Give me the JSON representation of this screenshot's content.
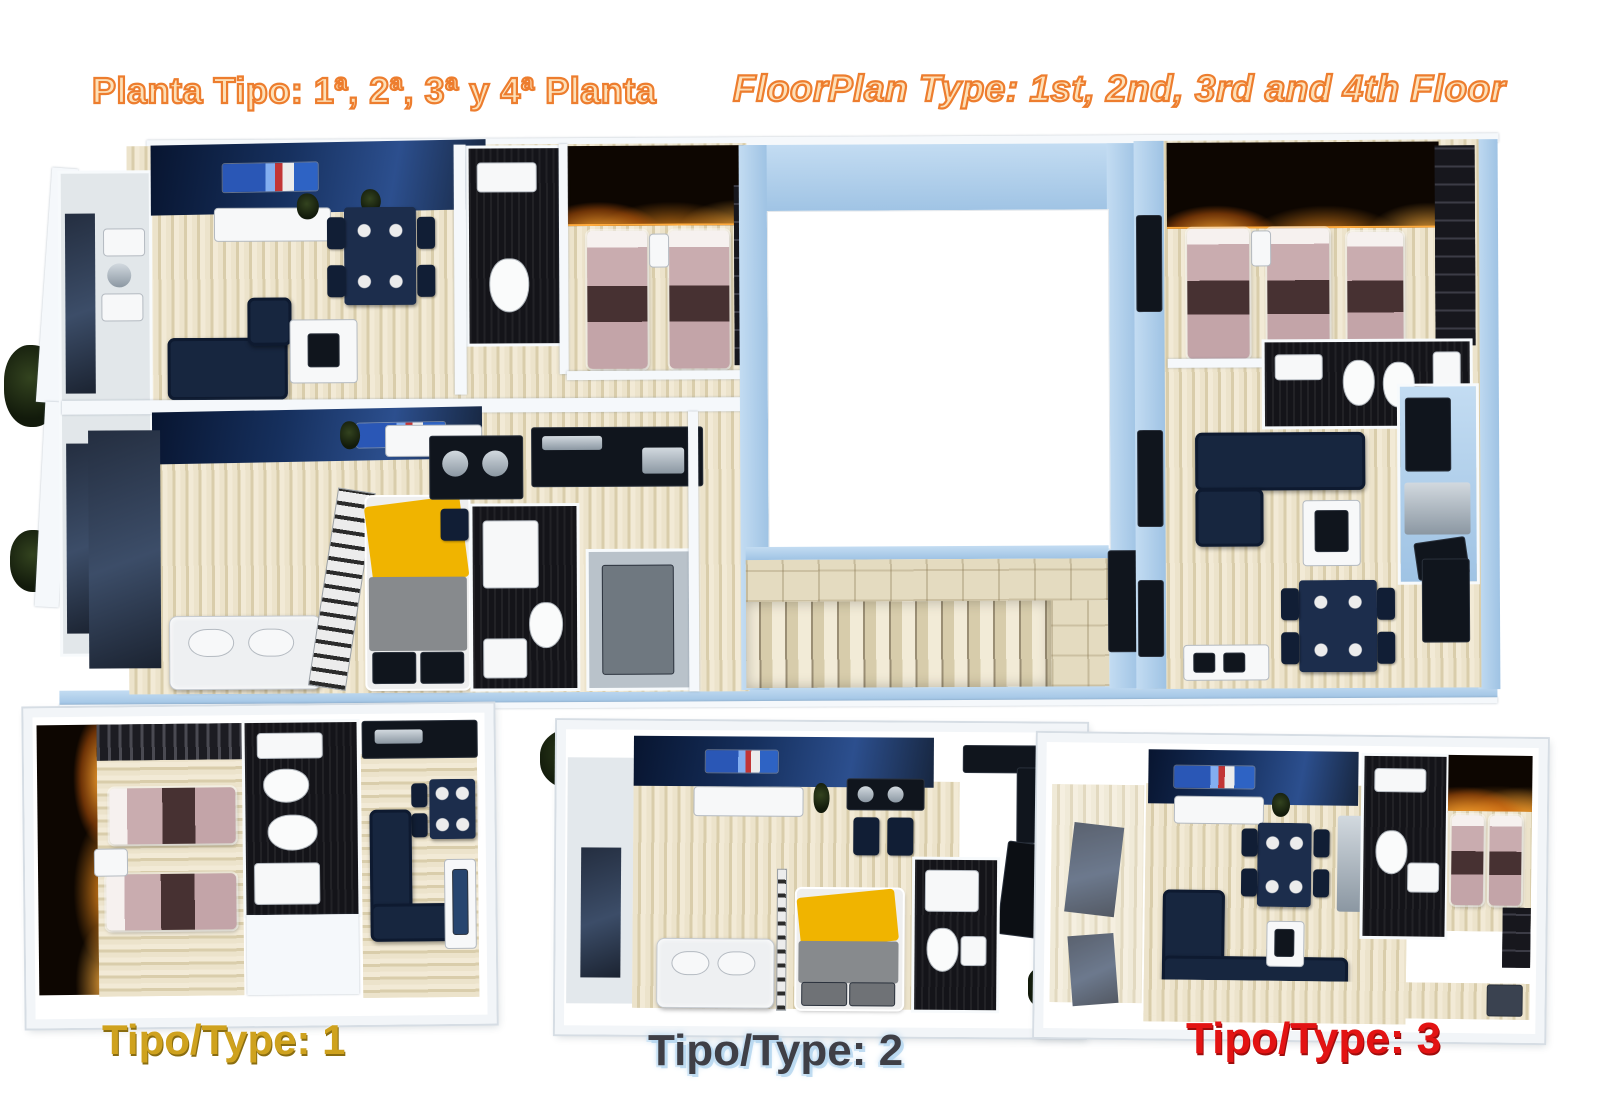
{
  "header": {
    "title_left": "Planta Tipo: 1ª, 2ª, 3ª y 4ª Planta",
    "title_right": "FloorPlan Type: 1st, 2nd, 3rd and 4th Floor"
  },
  "plans": {
    "type1": {
      "label": "Tipo/Type: 1"
    },
    "type2": {
      "label": "Tipo/Type: 2"
    },
    "type3": {
      "label": "Tipo/Type: 3"
    }
  },
  "colors": {
    "title_orange": "#ed7d2e",
    "label1_gold": "#cfa21e",
    "label2_dark": "#3f3f46",
    "label2_glow": "#a9cfec",
    "label3_red": "#e31313",
    "wall_blue": "#9fc3e4",
    "floor_beige": "#e8dfc6",
    "navy": "#17263f",
    "bed_pink": "#c9acaf",
    "glow_orange": "#ffab3d",
    "black_tile": "#141419",
    "yellow_blanket": "#f0b400"
  }
}
